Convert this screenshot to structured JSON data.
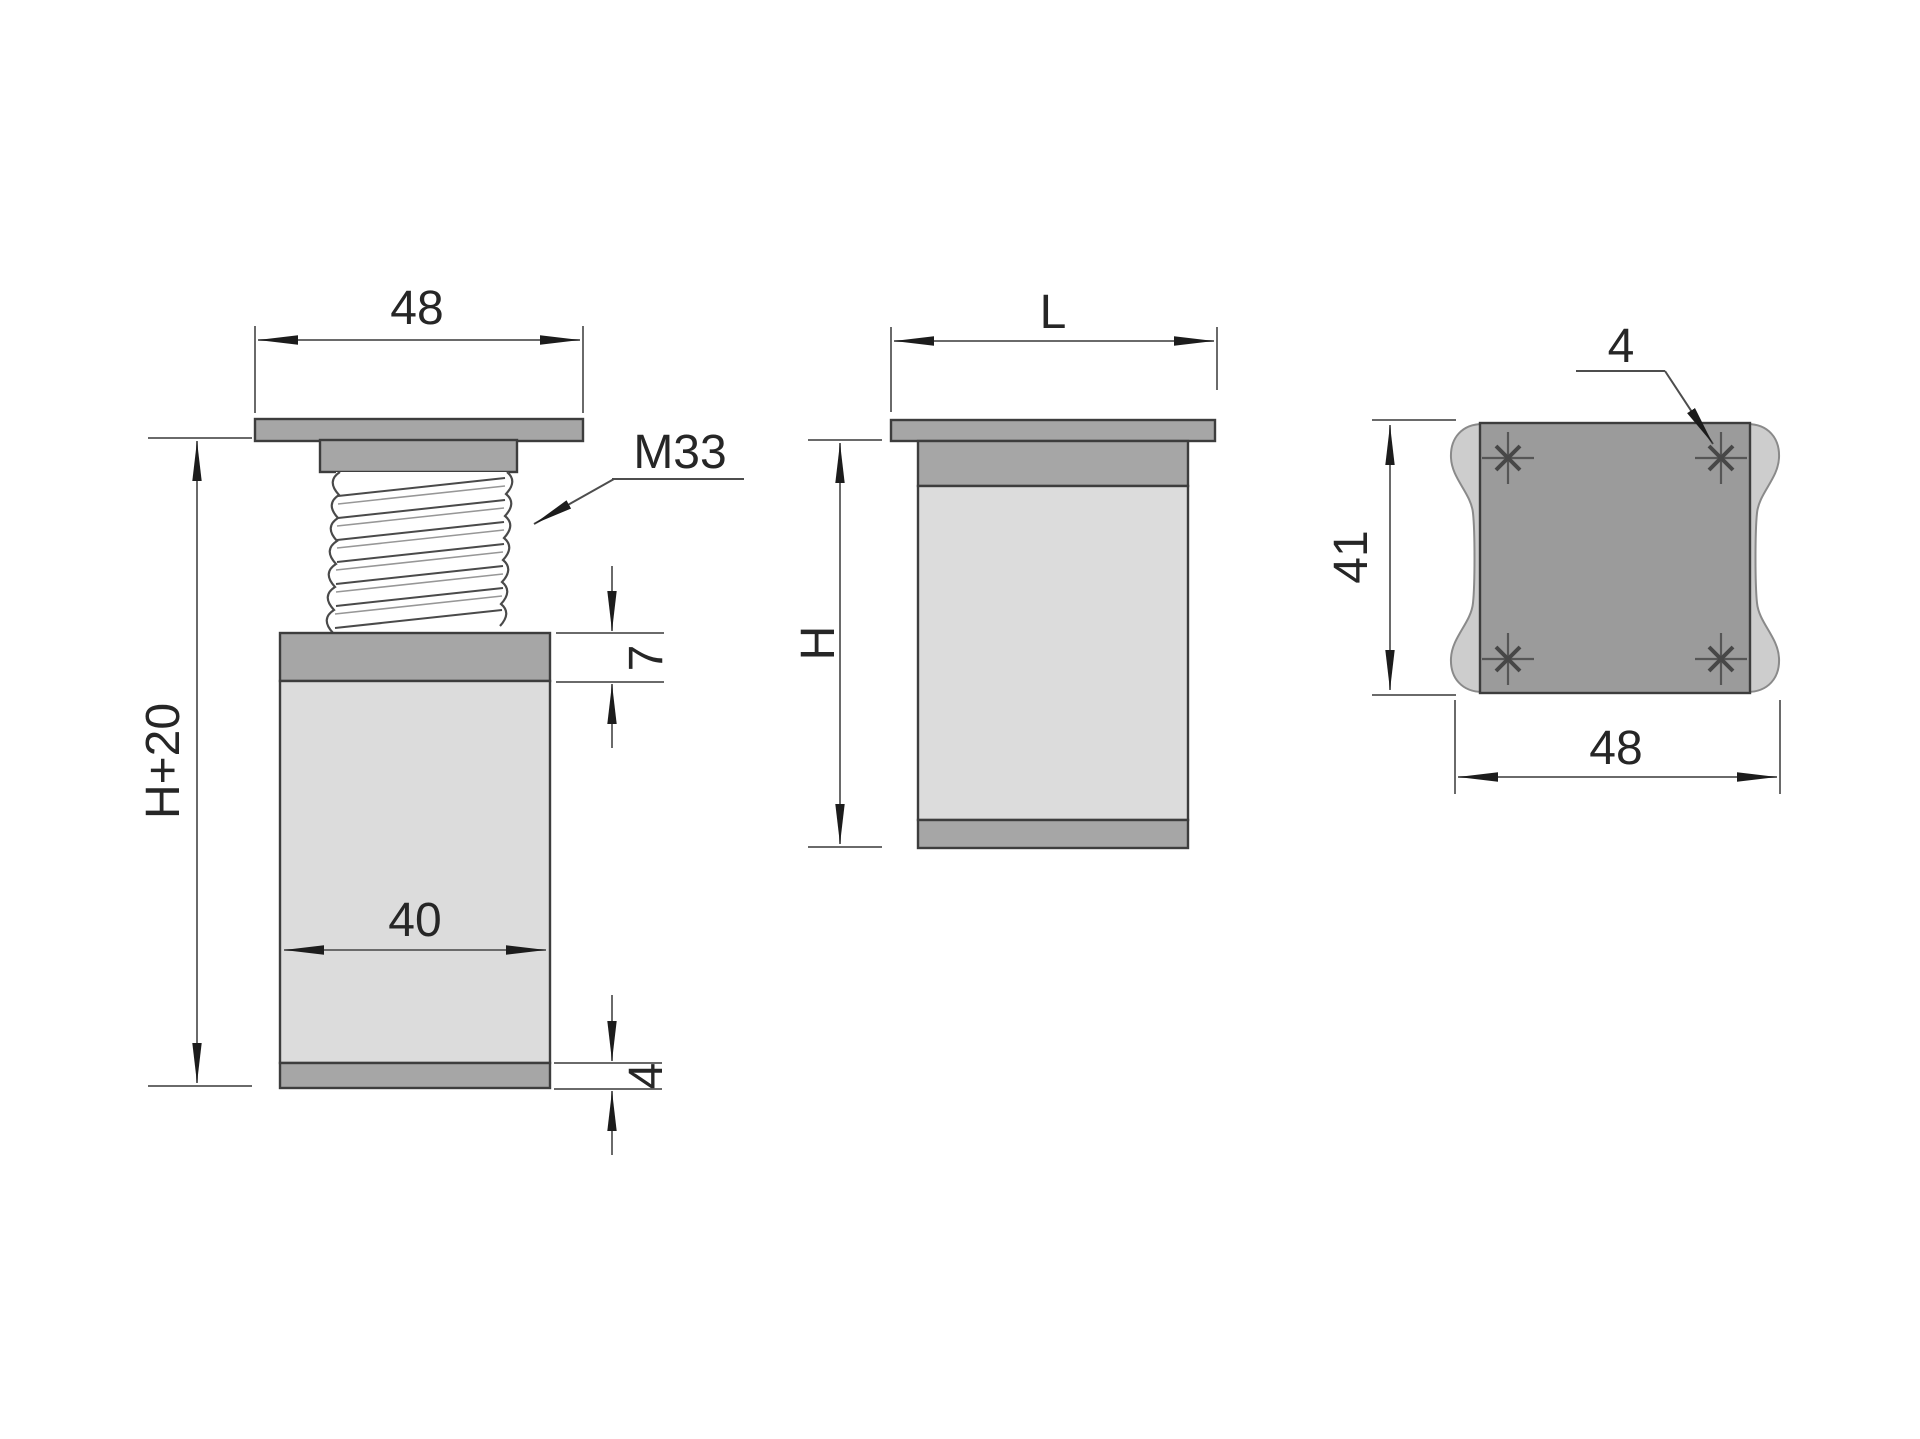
{
  "views": {
    "front": {
      "top_width": "48",
      "thread": "M33",
      "overall_height": "H+20",
      "collar_height": "7",
      "body_width": "40",
      "foot_height": "4"
    },
    "side": {
      "top_width": "L",
      "height": "H"
    },
    "top": {
      "hole_count": "4",
      "plate_depth": "41",
      "plate_width": "48"
    }
  },
  "colors": {
    "background": "#ffffff",
    "body_fill": "#dcdcdc",
    "band_fill": "#a6a6a6",
    "plate_fill": "#9b9b9b",
    "profile_fill": "#cdcdcd",
    "line": "#3d3d3d",
    "dim": "#6a6a6a",
    "text": "#262626",
    "arrow": "#1c1c1c"
  }
}
